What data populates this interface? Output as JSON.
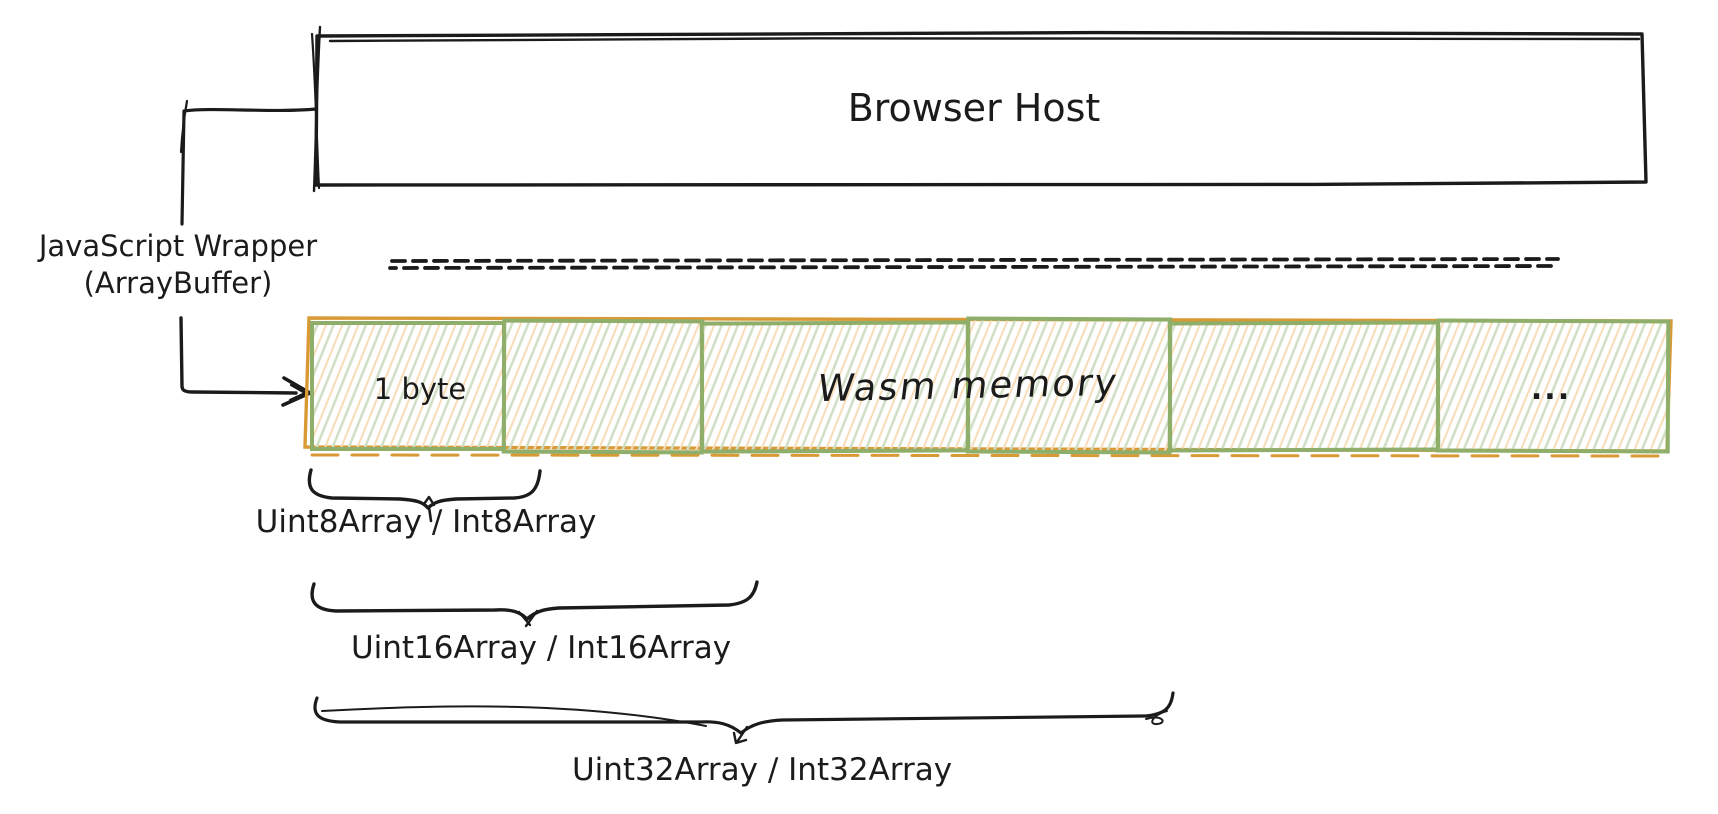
{
  "diagram": {
    "host_box": {
      "label": "Browser Host"
    },
    "wrapper": {
      "line1": "JavaScript Wrapper",
      "line2": "(ArrayBuffer)"
    },
    "memory": {
      "cell_count": 6,
      "cell1_label": "1 byte",
      "overlay_label": "Wasm memory",
      "ellipsis_label": "..."
    },
    "typed_arrays": [
      {
        "label": "Uint8Array / Int8Array",
        "span_cells": 1
      },
      {
        "label": "Uint16Array / Int16Array",
        "span_cells": 2
      },
      {
        "label": "Uint32Array / Int32Array",
        "span_cells": 4
      }
    ],
    "colors": {
      "stroke": "#1b1b1b",
      "cell_border": "#8fae6a",
      "strip_outline": "#d99a35",
      "hatch_green": "#cfdec4",
      "hatch_orange": "#f7ddba"
    }
  }
}
